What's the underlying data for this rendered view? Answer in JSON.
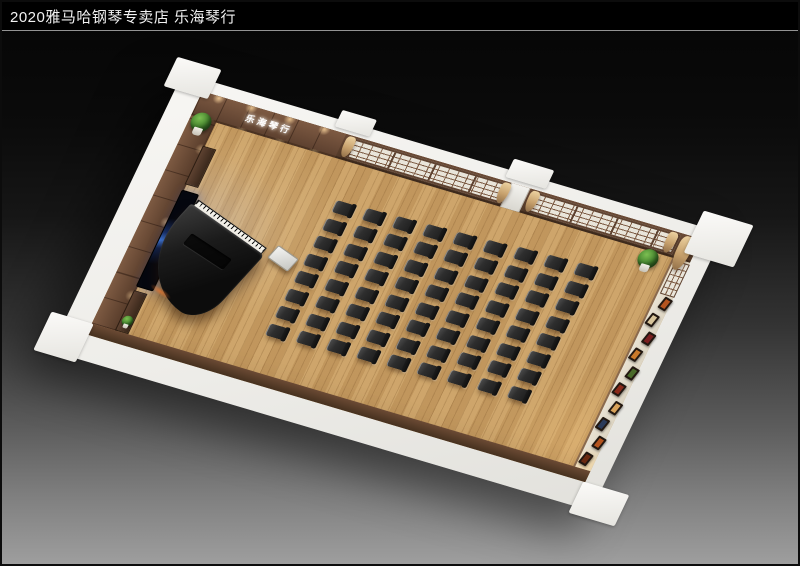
{
  "title_bar": {
    "text": "2020雅马哈钢琴专卖店 乐海琴行"
  },
  "room": {
    "sign_text": "乐海琴行",
    "seating": {
      "rows": 8,
      "cols": 9,
      "total": 72
    },
    "right_wall_frames": {
      "count": 10,
      "colors": [
        "#b4541f",
        "#d8c49a",
        "#7a1f1f",
        "#c97a2a",
        "#4a6a2a",
        "#8a2a1a",
        "#d8a25a",
        "#2a3a5a",
        "#b4541f",
        "#6a2a10"
      ]
    },
    "windows": {
      "groups": 2,
      "curtains": 5
    },
    "plants": 3,
    "stage": {
      "piano": "grand-piano",
      "screen": "video-wall",
      "bench": "white-bench"
    },
    "colors": {
      "bg_top": "#050505",
      "bg_bottom": "#9e9e9e",
      "floor": "#c89e63",
      "wood_light": "#7d5a42",
      "outer_wall": "#f2f1ee",
      "chair": "#2e2e2e",
      "curtain": "#c6a06c",
      "plant": "#3f7d2a"
    }
  }
}
